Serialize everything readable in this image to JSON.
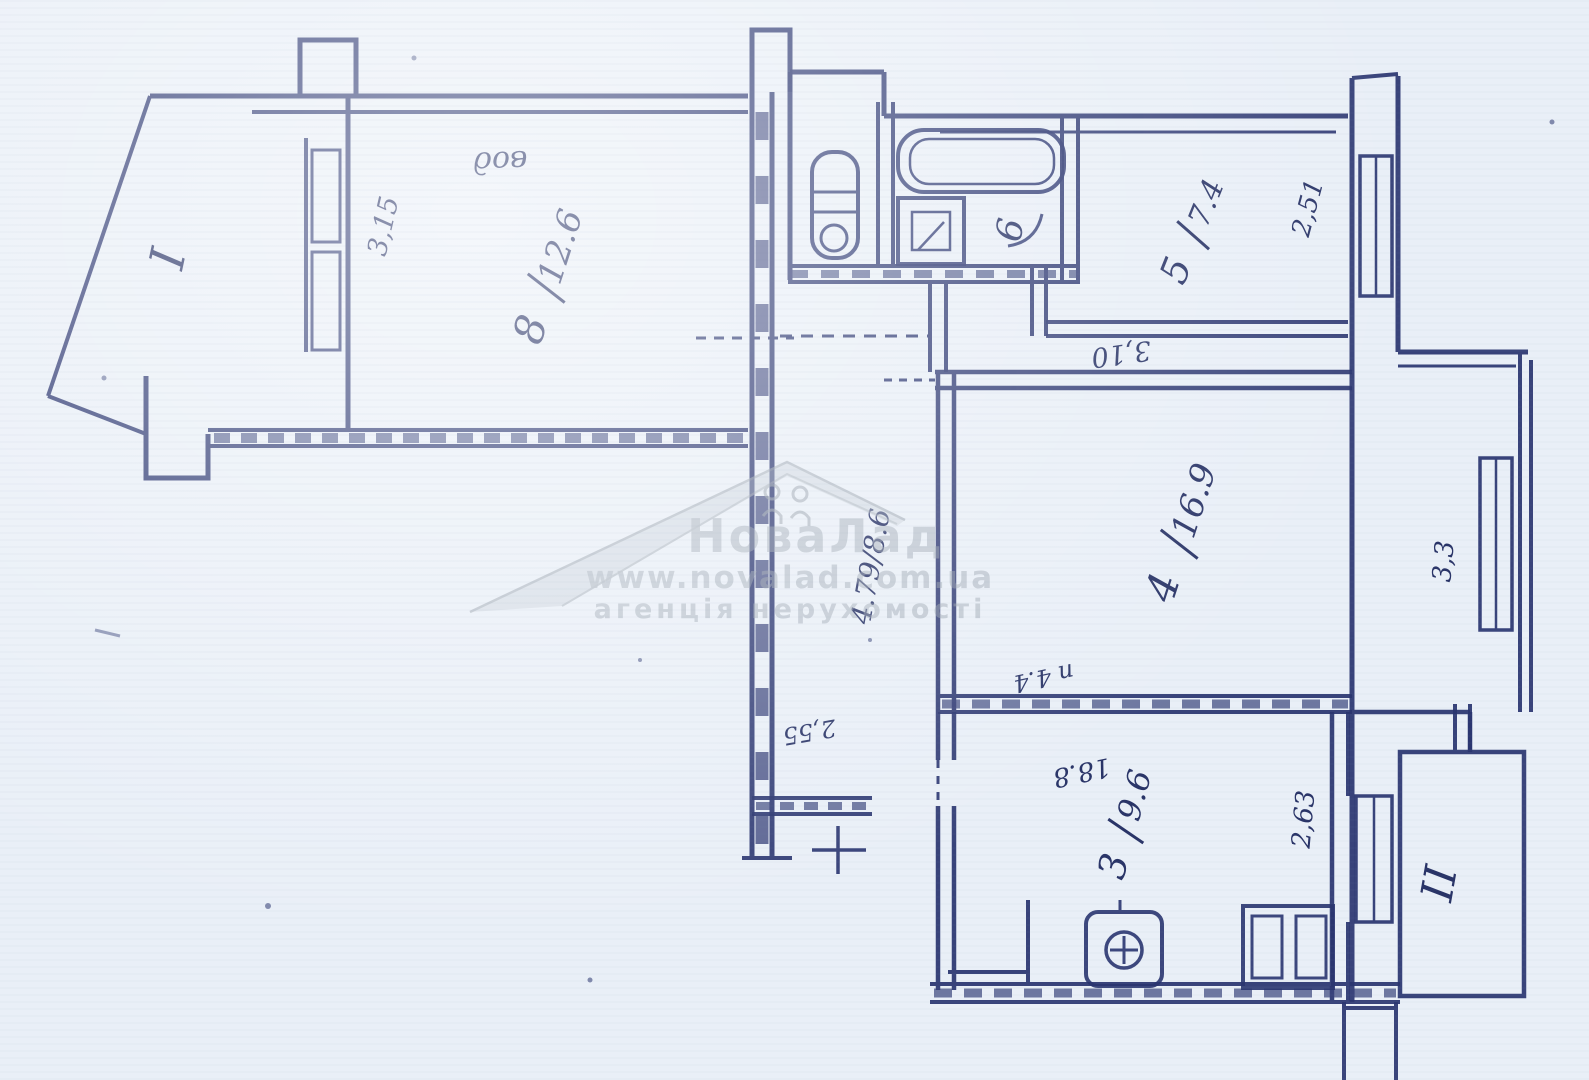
{
  "palette": {
    "paper": "#e9eff7",
    "ink": "#2a3570",
    "watermark": "#98a2ad"
  },
  "watermark": {
    "brand": "НоваЛад",
    "url": "www.novalad.com.ua",
    "tagline": "агенція нерухомості",
    "logo": "roof-with-family-icon"
  },
  "rooms": {
    "room8": {
      "number": "8",
      "area": "12.6"
    },
    "room5": {
      "number": "5",
      "area": "7.4"
    },
    "room6": {
      "number": "6"
    },
    "room4": {
      "number": "4",
      "area": "16.9"
    },
    "room3": {
      "number": "3",
      "area": "9.6"
    },
    "hallway": {
      "label": "4.79/8.6"
    }
  },
  "balconies": {
    "first": "I",
    "second": "II"
  },
  "dimensions": {
    "d315": "3,15",
    "d251": "2,51",
    "d310": "3,10",
    "d33": "3,3",
    "d263": "2,63",
    "d255": "2,55",
    "d188": "18.8",
    "d44": "п 4.4"
  },
  "handwriting": {
    "note": "вод"
  },
  "fixtures": [
    "toilet-icon",
    "bathtub-icon",
    "washbasin-icon",
    "stove-icon",
    "cabinet-icon"
  ]
}
